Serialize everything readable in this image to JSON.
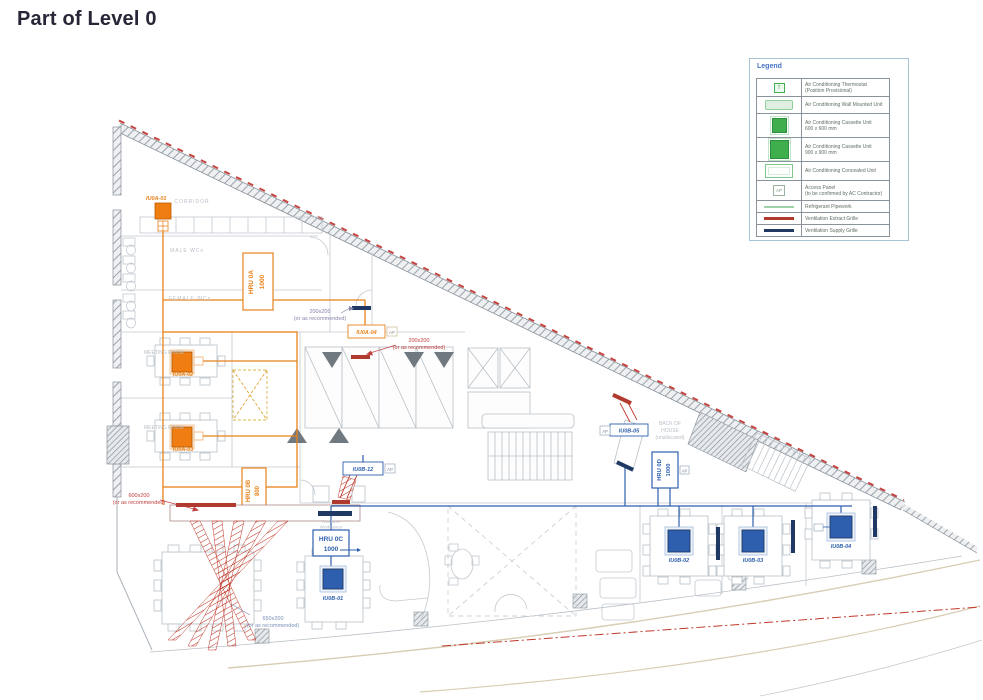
{
  "title": "Part of Level 0",
  "legend": {
    "title": "Legend",
    "items": [
      {
        "icon": "thermostat-icon",
        "line1": "Air Conditioning Thermostat",
        "line2": "(Position Provisional)"
      },
      {
        "icon": "wall-mounted-unit-icon",
        "line1": "Air Conditioning Wall Mounted Unit",
        "line2": ""
      },
      {
        "icon": "cassette-unit-600-icon",
        "line1": "Air Conditioning Cassette Unit",
        "line2": "600 x 600 mm"
      },
      {
        "icon": "cassette-unit-900-icon",
        "line1": "Air Conditioning Cassette Unit",
        "line2": "900 x 900 mm"
      },
      {
        "icon": "concealed-unit-icon",
        "line1": "Air Conditioning Concealed Unit",
        "line2": ""
      },
      {
        "icon": "access-panel-icon",
        "line1": "Access Panel",
        "line2": "(to be confirmed by AC Contractor)"
      },
      {
        "icon": "refrigerant-pipework-icon",
        "line1": "Refrigerant Pipework",
        "line2": ""
      },
      {
        "icon": "extract-grille-icon",
        "line1": "Ventilation Extract Grille",
        "line2": ""
      },
      {
        "icon": "supply-grille-icon",
        "line1": "Ventilation Supply Grille",
        "line2": ""
      }
    ],
    "ap_glyph": "AP",
    "thermo_glyph": "T"
  },
  "rooms": {
    "corridor": "CORRIDOR",
    "male_wc": "MALE WCs",
    "female_wc": "FEMALE WCs",
    "meeting_room": "MEETING ROOM",
    "boh1": "BACK OF",
    "boh2": "HOUSE",
    "boh3": "(unallocated)",
    "hru0c_note1": "Available",
    "hru0c_note2": "Workspace"
  },
  "units": {
    "iu0a01": "IU0A-01",
    "iu0a02": "IU0A-02",
    "iu0a03": "IU0A-03",
    "iu0a04": "IU0A-04",
    "iu0b01": "IU0B-01",
    "iu0b02": "IU0B-02",
    "iu0b03": "IU0B-03",
    "iu0b04": "IU0B-04",
    "iu0b05": "IU0B-05",
    "iu0b12": "IU0B-12",
    "hru0a_name": "HRU 0A",
    "hru0a_size": "1000",
    "hru0b_name": "HRU 0B",
    "hru0b_size": "800",
    "hru0c_name": "HRU 0C",
    "hru0c_size": "1000",
    "hru0d_name": "HRU 0D",
    "hru0d_size": "1000",
    "ap": "AP"
  },
  "annotations": {
    "a1_line1": "200x200",
    "a1_line2": "(or as recommended)",
    "a2_line1": "200x200",
    "a2_line2": "(or as recommended)",
    "a3_line1": "600x200",
    "a3_line2": "(or as recommended)",
    "a4_line1": "650x200",
    "a4_line2": "(or as recommended)"
  },
  "colors": {
    "system_0a_orange": "#e8821a",
    "system_0b_blue": "#2e5fae",
    "extract_red": "#b03a2e",
    "supply_navy": "#1f3864",
    "cassette_green": "#3fae4c",
    "refrigerant_green": "#9fd4a8",
    "legend_title_blue": "#4472c4",
    "wall_gray": "#9aa3ab"
  }
}
